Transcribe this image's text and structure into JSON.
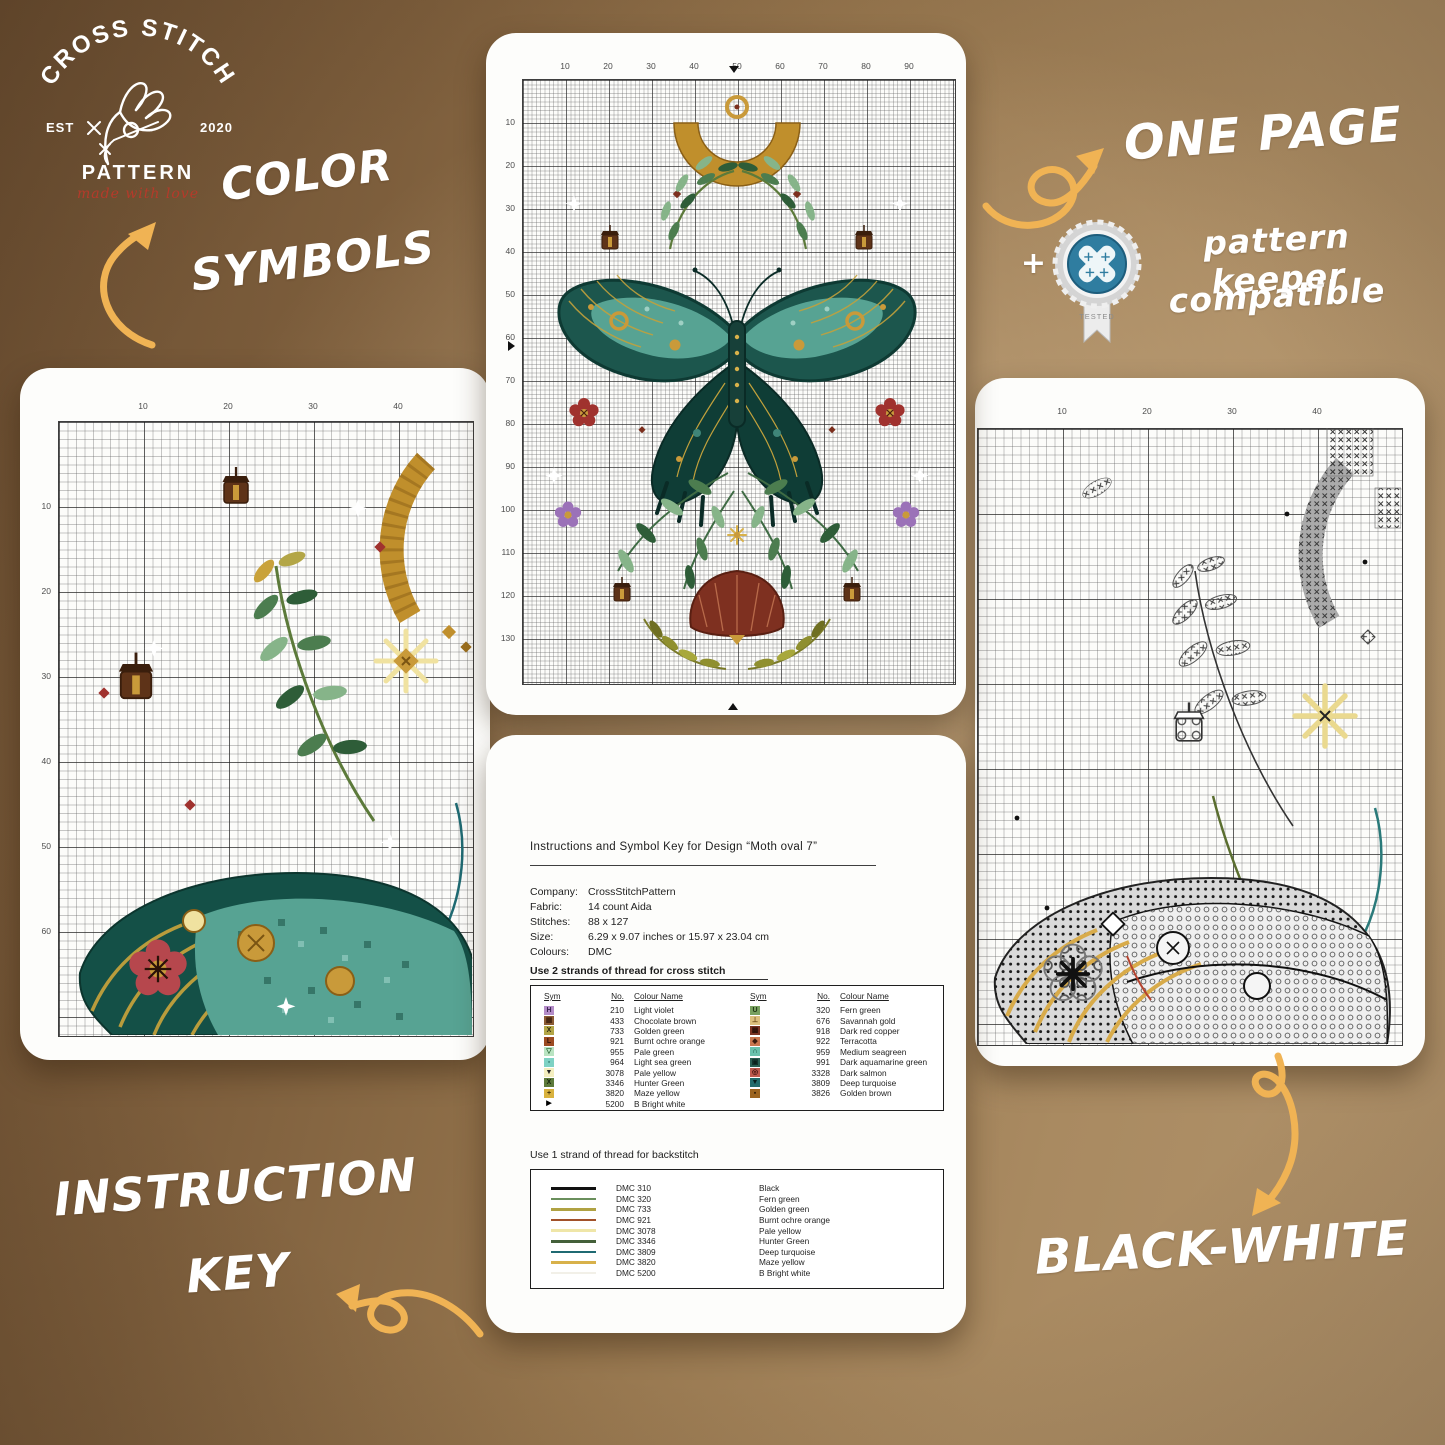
{
  "colors": {
    "background_brown": "#8a6a46",
    "card_white": "#fdfdfb",
    "arrow_gold": "#f0b354",
    "annotation_white": "#ffffff",
    "logo_tagline_red": "#b53a2a",
    "badge_teal": "#2f7da0"
  },
  "logo": {
    "arc": "CROSS STITCH",
    "est": "EST",
    "year": "2020",
    "name": "PATTERN",
    "tagline": "made with love"
  },
  "labels": {
    "color_symbols_1": "COLOR",
    "color_symbols_2": "SYMBOLS",
    "one_page": "ONE PAGE",
    "plus": "+",
    "pattern_keeper_1": "pattern keeper",
    "pattern_keeper_2": "compatible",
    "badge_tested": "TESTED",
    "instruction_key_1": "INSTRUCTION",
    "instruction_key_2": "KEY",
    "black_white": "BLACK-WHITE"
  },
  "cards": {
    "center_top": {
      "top_ticks": [
        "10",
        "20",
        "30",
        "40",
        "50",
        "60",
        "70",
        "80",
        "90"
      ],
      "left_ticks": [
        "10",
        "20",
        "30",
        "40",
        "50",
        "60",
        "70",
        "80",
        "90",
        "100",
        "110",
        "120",
        "130"
      ]
    },
    "left_detail": {
      "top_ticks": [
        "10",
        "20",
        "30",
        "40"
      ],
      "left_ticks": [
        "10",
        "20",
        "30",
        "40",
        "50",
        "60"
      ]
    },
    "right_bw": {
      "top_ticks": [
        "10",
        "20",
        "30",
        "40"
      ]
    }
  },
  "instructions": {
    "title": "Instructions and Symbol Key for Design “Moth oval 7”",
    "meta": [
      {
        "label": "Company:",
        "value": "CrossStitchPattern"
      },
      {
        "label": "Fabric:",
        "value": "14 count Aida"
      },
      {
        "label": "Stitches:",
        "value": "88 x 127"
      },
      {
        "label": "Size:",
        "value": "6.29 x 9.07 inches or 15.97 x 23.04 cm"
      },
      {
        "label": "Colours:",
        "value": "DMC"
      }
    ],
    "use2": "Use 2 strands of thread for cross stitch",
    "use1": "Use 1 strand of thread for backstitch",
    "headers": [
      "Sym",
      "No.",
      "Colour Name"
    ],
    "cross_left": [
      {
        "sym": "H",
        "bg": "#b48cc8",
        "fg": "#3a2350",
        "no": "210",
        "name": "Light violet"
      },
      {
        "sym": "▦",
        "bg": "#8a5a33",
        "fg": "#40220e",
        "no": "433",
        "name": "Chocolate brown"
      },
      {
        "sym": "X",
        "bg": "#b3a647",
        "fg": "#2e2a10",
        "no": "733",
        "name": "Golden green"
      },
      {
        "sym": "L",
        "bg": "#9c4a22",
        "fg": "#33140a",
        "no": "921",
        "name": "Burnt ochre orange"
      },
      {
        "sym": "▽",
        "bg": "#b9e4c2",
        "fg": "#1d5a2a",
        "no": "955",
        "name": "Pale green"
      },
      {
        "sym": "▫",
        "bg": "#7ed2c4",
        "fg": "#0e4f46",
        "no": "964",
        "name": "Light sea green"
      },
      {
        "sym": "▼",
        "bg": "#f4eebf",
        "fg": "#222222",
        "no": "3078",
        "name": "Pale yellow"
      },
      {
        "sym": "X",
        "bg": "#5d7a3a",
        "fg": "#15230c",
        "no": "3346",
        "name": "Hunter Green"
      },
      {
        "sym": "+",
        "bg": "#d9b23f",
        "fg": "#3a2c08",
        "no": "3820",
        "name": "Maze yellow"
      },
      {
        "sym": "▶",
        "bg": "#ffffff",
        "fg": "#000000",
        "no": "5200",
        "name": "B Bright white"
      }
    ],
    "cross_right": [
      {
        "sym": "U",
        "bg": "#77a05f",
        "fg": "#1d3312",
        "no": "320",
        "name": "Fern green"
      },
      {
        "sym": "⊥",
        "bg": "#dcbf7d",
        "fg": "#6b4a16",
        "no": "676",
        "name": "Savannah gold"
      },
      {
        "sym": "▩",
        "bg": "#7a3222",
        "fg": "#2c0f08",
        "no": "918",
        "name": "Dark red copper"
      },
      {
        "sym": "◆",
        "bg": "#c9764f",
        "fg": "#3c1c0e",
        "no": "922",
        "name": "Terracotta"
      },
      {
        "sym": "∩",
        "bg": "#69c2ad",
        "fg": "#0d4034",
        "no": "959",
        "name": "Medium seagreen"
      },
      {
        "sym": "▣",
        "bg": "#2a5e52",
        "fg": "#0a211c",
        "no": "991",
        "name": "Dark aquamarine green"
      },
      {
        "sym": "◎",
        "bg": "#bf5a4e",
        "fg": "#3c0f0c",
        "no": "3328",
        "name": "Dark salmon"
      },
      {
        "sym": "▼",
        "bg": "#226b6b",
        "fg": "#06201f",
        "no": "3809",
        "name": "Deep turquoise"
      },
      {
        "sym": "▪",
        "bg": "#9c6420",
        "fg": "#2f1c06",
        "no": "3826",
        "name": "Golden brown"
      }
    ],
    "backstitch": [
      {
        "code": "DMC 310",
        "name": "Black",
        "color": "#111111"
      },
      {
        "code": "DMC 320",
        "name": "Fern green",
        "color": "#6a8f5c"
      },
      {
        "code": "DMC 733",
        "name": "Golden green",
        "color": "#b0a243"
      },
      {
        "code": "DMC 921",
        "name": "Burnt ochre orange",
        "color": "#a2512a"
      },
      {
        "code": "DMC 3078",
        "name": "Pale yellow",
        "color": "#efe6a8"
      },
      {
        "code": "DMC 3346",
        "name": "Hunter Green",
        "color": "#44603a"
      },
      {
        "code": "DMC 3809",
        "name": "Deep turquoise",
        "color": "#1f6a72"
      },
      {
        "code": "DMC 3820",
        "name": "Maze yellow",
        "color": "#d8b14a"
      },
      {
        "code": "DMC 5200",
        "name": "B Bright white",
        "color": "#f2f0e8"
      }
    ]
  }
}
